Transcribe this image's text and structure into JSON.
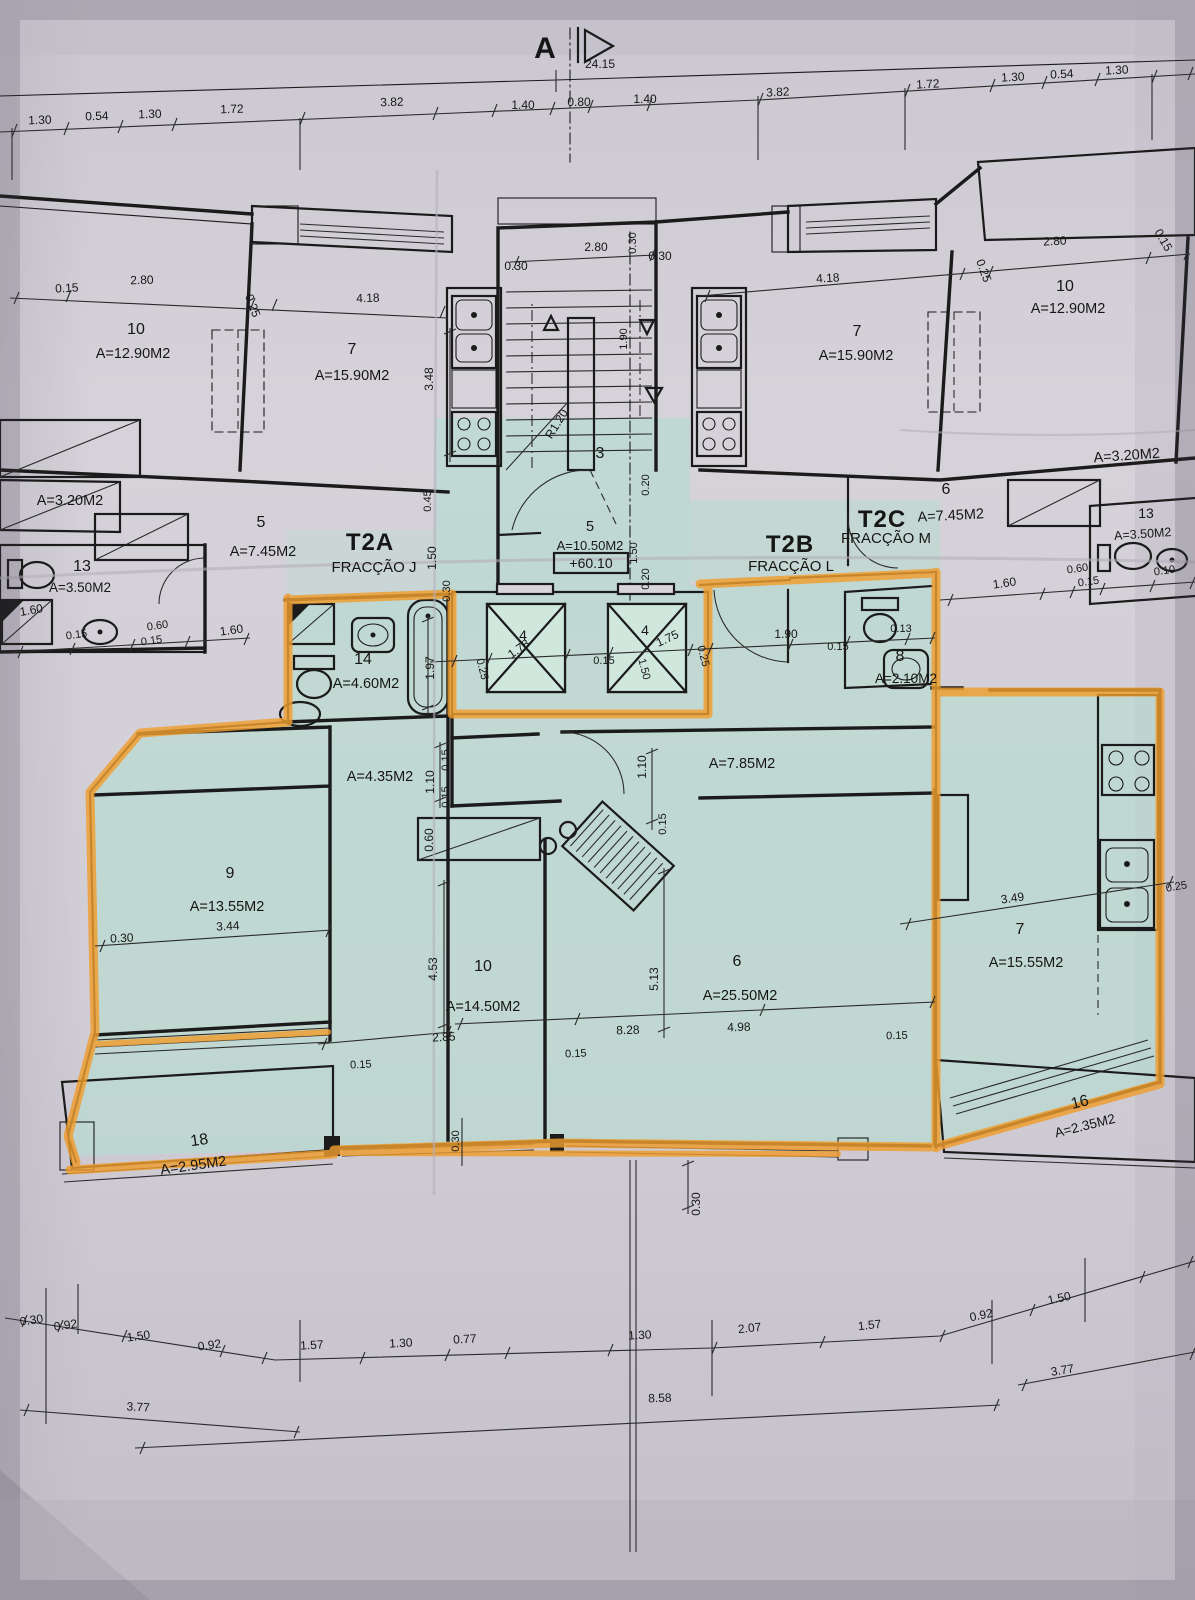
{
  "sheet": {
    "section_marker": "A",
    "dim_total": "24.15",
    "elevation": "+60.10"
  },
  "colors": {
    "paper": "#d0ccd4",
    "highlight_teal": "#b4ddd0",
    "highlight_orange": "#f09d2e",
    "ink": "#1b1b1b"
  },
  "fractions": {
    "t2a_code": "T2A",
    "t2a_name": "FRACÇÃO J",
    "t2b_code": "T2B",
    "t2b_name": "FRACÇÃO L",
    "t2c_code": "T2C",
    "t2c_name": "FRACÇÃO M"
  },
  "rooms": {
    "ul_bed_num": "10",
    "ul_bed_area": "A=12.90M2",
    "ul_liv_num": "7",
    "ul_liv_area": "A=15.90M2",
    "ul_store_area": "A=3.20M2",
    "ul_hall_num": "5",
    "ul_hall_area": "A=7.45M2",
    "ul_bath_num": "13",
    "ul_bath_area": "A=3.50M2",
    "stair_num": "3",
    "hall5_num": "5",
    "hall5_area": "A=10.50M2",
    "ur_liv_num": "7",
    "ur_liv_area": "A=15.90M2",
    "ur_bed_num": "10",
    "ur_bed_area": "A=12.90M2",
    "ur_store_area": "A=3.20M2",
    "ur_hall_num": "6",
    "ur_hall_area": "A=7.45M2",
    "ur_bath_num": "13",
    "ur_bath_area": "A=3.50M2",
    "lift_left_num": "4",
    "lift_right_num": "4",
    "lo_bath_num": "14",
    "lo_bath_area": "A=4.60M2",
    "lo_wc_num": "8",
    "lo_wc_area": "A=2.10M2",
    "lo_hall_area": "A=4.35M2",
    "lo_corridor_area": "A=7.85M2",
    "lo_bed1_num": "9",
    "lo_bed1_area": "A=13.55M2",
    "lo_bed2_num": "10",
    "lo_bed2_area": "A=14.50M2",
    "lo_living_num": "6",
    "lo_living_area": "A=25.50M2",
    "lo_kitchen_num": "7",
    "lo_kitchen_area": "A=15.55M2",
    "balc_left_num": "18",
    "balc_left_area": "A=2.95M2",
    "balc_right_num": "16",
    "balc_right_area": "A=2.35M2"
  },
  "dims": {
    "top": [
      "1.30",
      "0.54",
      "1.30",
      "1.72",
      "3.82",
      "1.40",
      "0.80",
      "1.40",
      "3.82",
      "1.72",
      "1.30",
      "0.54",
      "1.30"
    ],
    "ul": [
      "0.15",
      "2.80",
      "0.25",
      "4.18",
      "3.48",
      "0.45",
      "1.50",
      "0.30"
    ],
    "stair": [
      "2.80",
      "0.30",
      "0.30",
      "0.30",
      "1.90",
      "R1.20",
      "0.20"
    ],
    "ur": [
      "4.18",
      "0.25",
      "2.80",
      "0.15"
    ],
    "midl": [
      "1.60",
      "0.15",
      "0.60",
      "0.15",
      "1.60"
    ],
    "midr": [
      "1.60",
      "0.60",
      "0.15",
      "0.10"
    ],
    "core": [
      "1.97",
      "0.25",
      "1.78",
      "0.15",
      "1.50",
      "1.75",
      "0.25",
      "1.90",
      "0.15",
      "0.13"
    ],
    "hall": [
      "0.15",
      "1.10",
      "0.15",
      "0.60",
      "1.10",
      "0.15"
    ],
    "low": [
      "3.44",
      "0.30",
      "4.53",
      "2.85",
      "0.15",
      "8.28",
      "5.13",
      "4.98",
      "0.15",
      "3.49",
      "0.25",
      "0.15",
      "0.30",
      "0.30"
    ],
    "bottom": [
      "0.30",
      "0.92",
      "1.50",
      "0.92",
      "1.57",
      "1.30",
      "0.77",
      "1.30",
      "2.07",
      "1.57",
      "0.92",
      "1.50"
    ],
    "totals": [
      "3.77",
      "8.58",
      "3.77"
    ],
    "axis": [
      "1.50",
      "0.20"
    ]
  }
}
